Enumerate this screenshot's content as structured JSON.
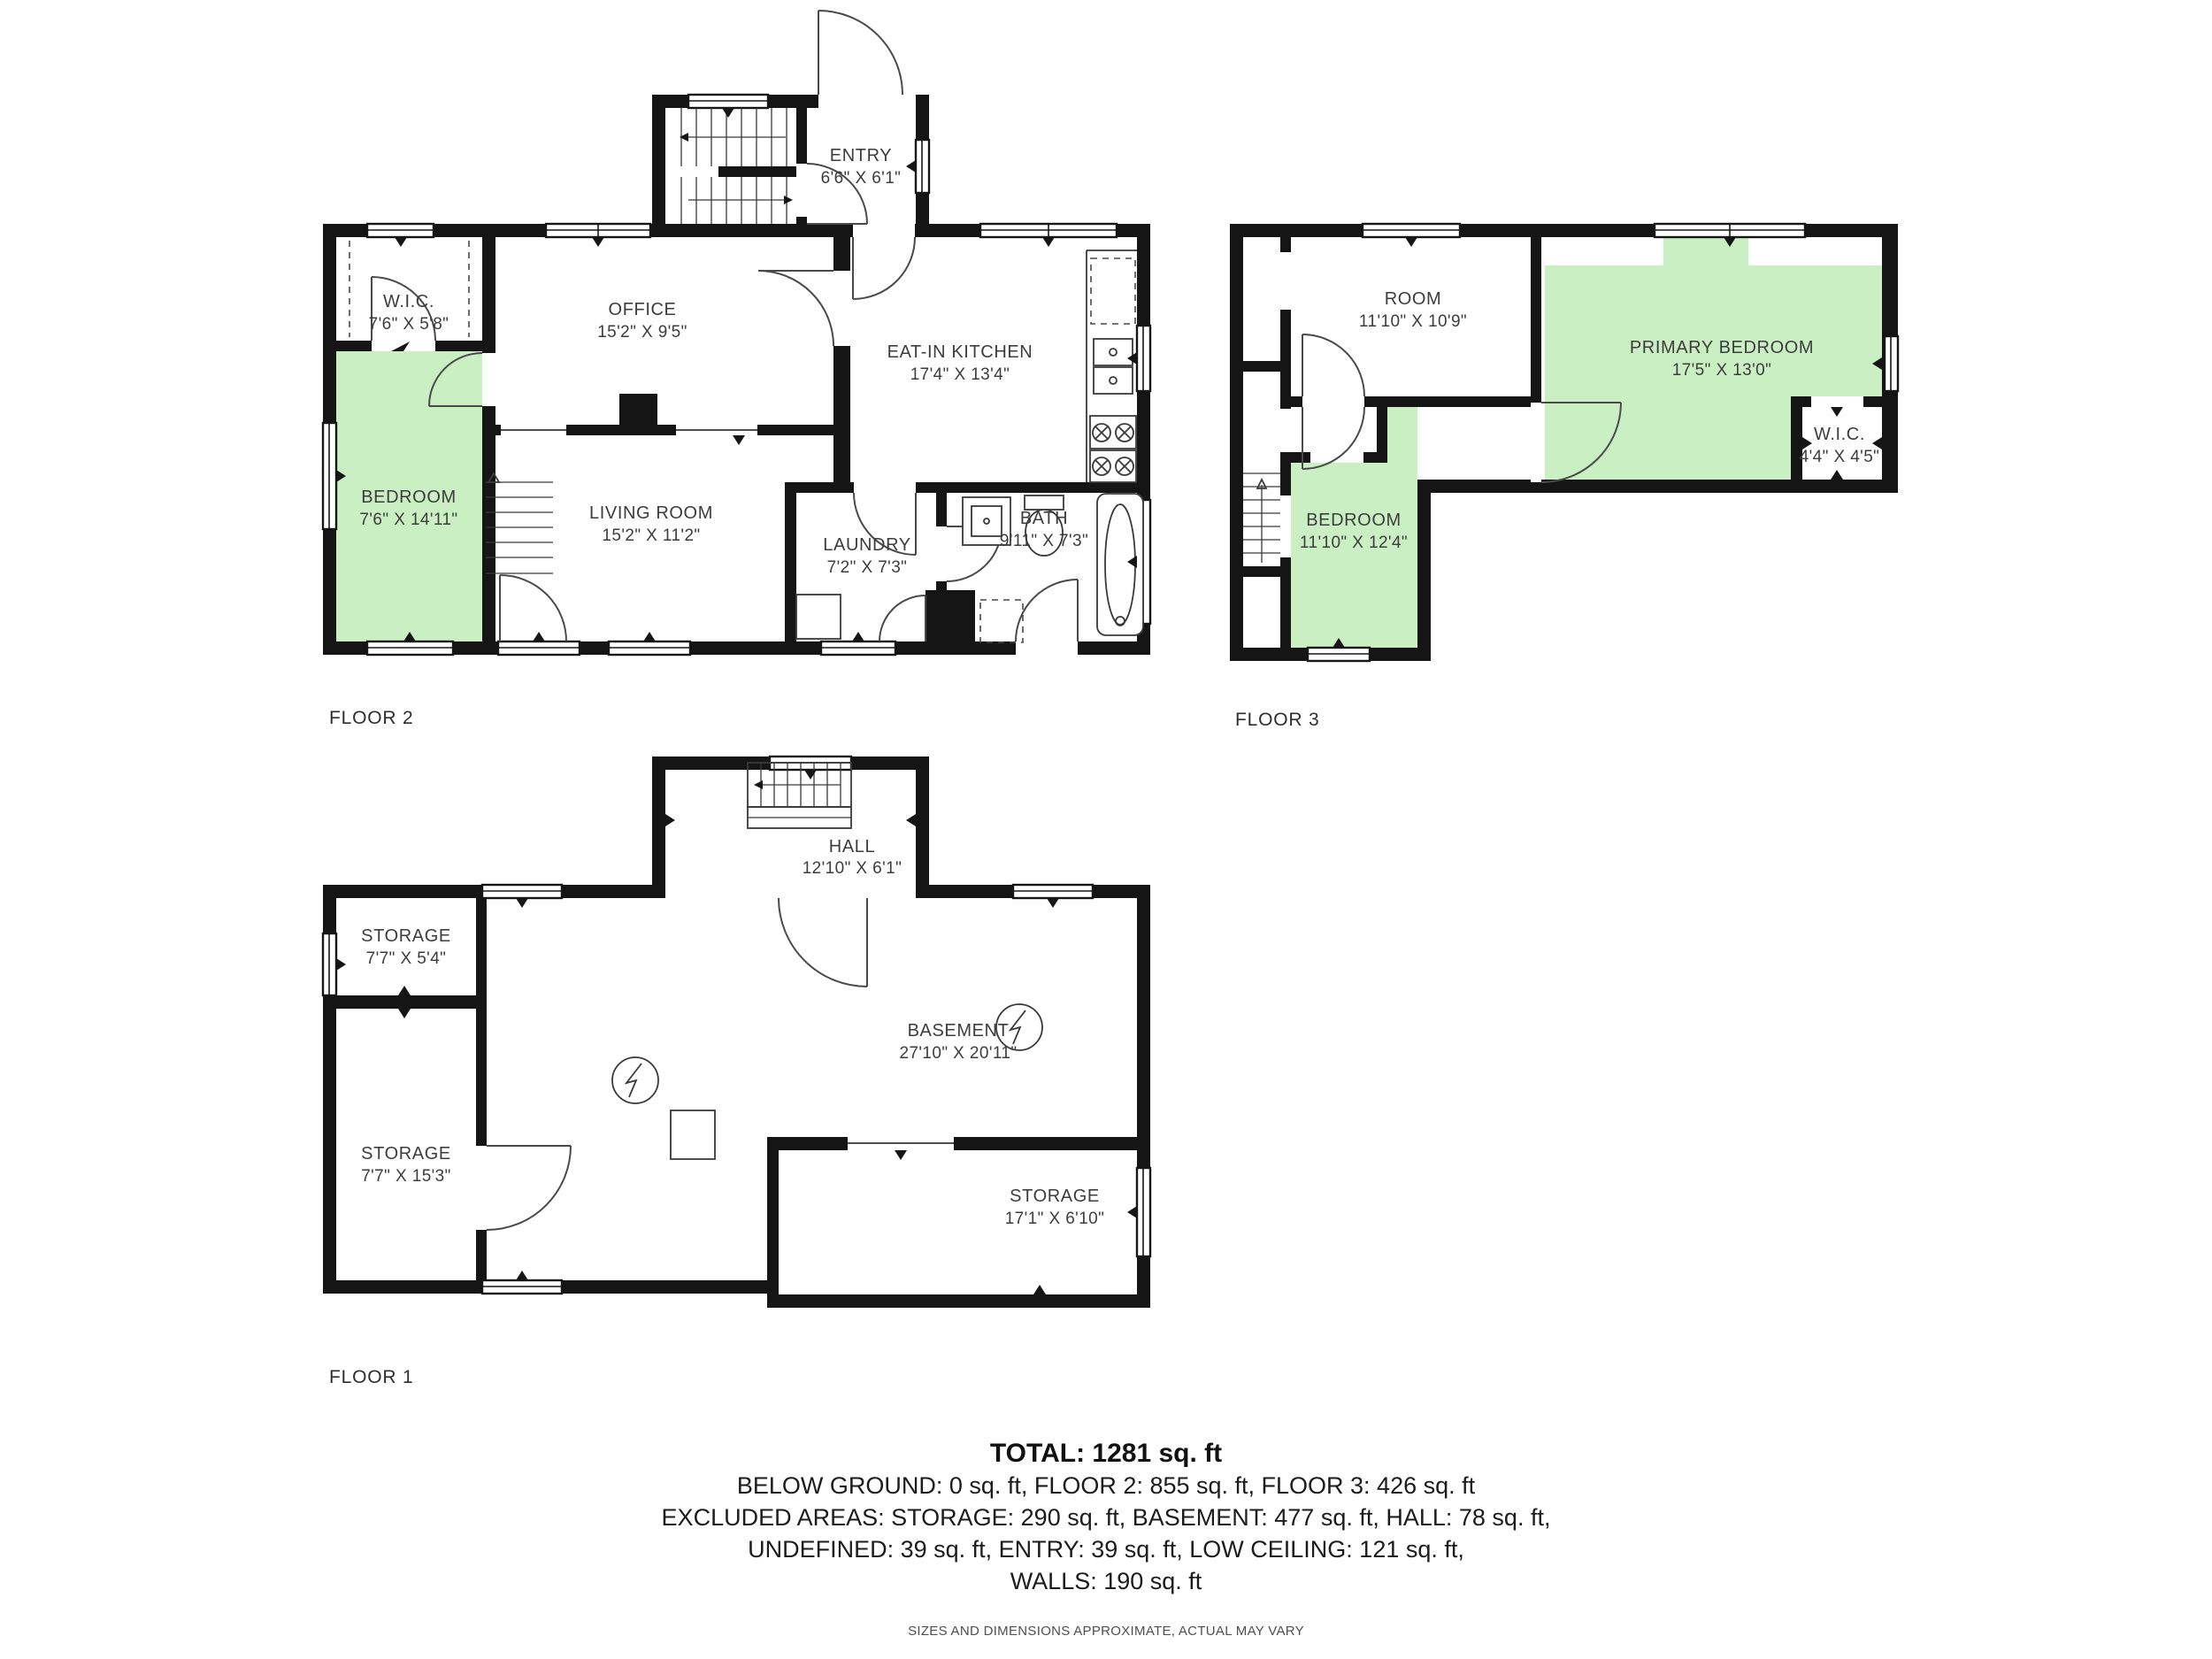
{
  "colors": {
    "wall": "#151515",
    "highlight": "#c9efc2",
    "label": "#3d3d3d",
    "arc": "#4a4a4a"
  },
  "floors": [
    {
      "label": "FLOOR 2",
      "rooms": [
        {
          "name": "ENTRY",
          "dims": "6'6\" X 6'1\""
        },
        {
          "name": "W.I.C.",
          "dims": "7'6\" X 5'8\""
        },
        {
          "name": "OFFICE",
          "dims": "15'2\" X 9'5\""
        },
        {
          "name": "EAT-IN KITCHEN",
          "dims": "17'4\" X 13'4\""
        },
        {
          "name": "BEDROOM",
          "dims": "7'6\" X 14'11\""
        },
        {
          "name": "LIVING ROOM",
          "dims": "15'2\" X 11'2\""
        },
        {
          "name": "LAUNDRY",
          "dims": "7'2\" X 7'3\""
        },
        {
          "name": "BATH",
          "dims": "9'11\" X 7'3\""
        }
      ]
    },
    {
      "label": "FLOOR 3",
      "rooms": [
        {
          "name": "ROOM",
          "dims": "11'10\" X 10'9\""
        },
        {
          "name": "PRIMARY BEDROOM",
          "dims": "17'5\" X 13'0\""
        },
        {
          "name": "W.I.C.",
          "dims": "4'4\" X 4'5\""
        },
        {
          "name": "BEDROOM",
          "dims": "11'10\" X 12'4\""
        }
      ]
    },
    {
      "label": "FLOOR 1",
      "rooms": [
        {
          "name": "HALL",
          "dims": "12'10\" X 6'1\""
        },
        {
          "name": "STORAGE",
          "dims": "7'7\" X 5'4\""
        },
        {
          "name": "BASEMENT",
          "dims": "27'10\" X 20'11\""
        },
        {
          "name": "STORAGE",
          "dims": "7'7\" X 15'3\""
        },
        {
          "name": "STORAGE",
          "dims": "17'1\" X 6'10\""
        }
      ]
    }
  ],
  "summary": {
    "total": "TOTAL: 1281 sq. ft",
    "line2": "BELOW GROUND: 0 sq. ft, FLOOR 2: 855 sq. ft, FLOOR 3: 426 sq. ft",
    "line3": "EXCLUDED AREAS: STORAGE: 290 sq. ft, BASEMENT: 477 sq. ft, HALL: 78 sq. ft,",
    "line4": "UNDEFINED: 39 sq. ft, ENTRY: 39 sq. ft, LOW CEILING: 121 sq. ft,",
    "line5": "WALLS: 190 sq. ft",
    "disclaimer": "SIZES AND DIMENSIONS APPROXIMATE, ACTUAL MAY VARY"
  }
}
